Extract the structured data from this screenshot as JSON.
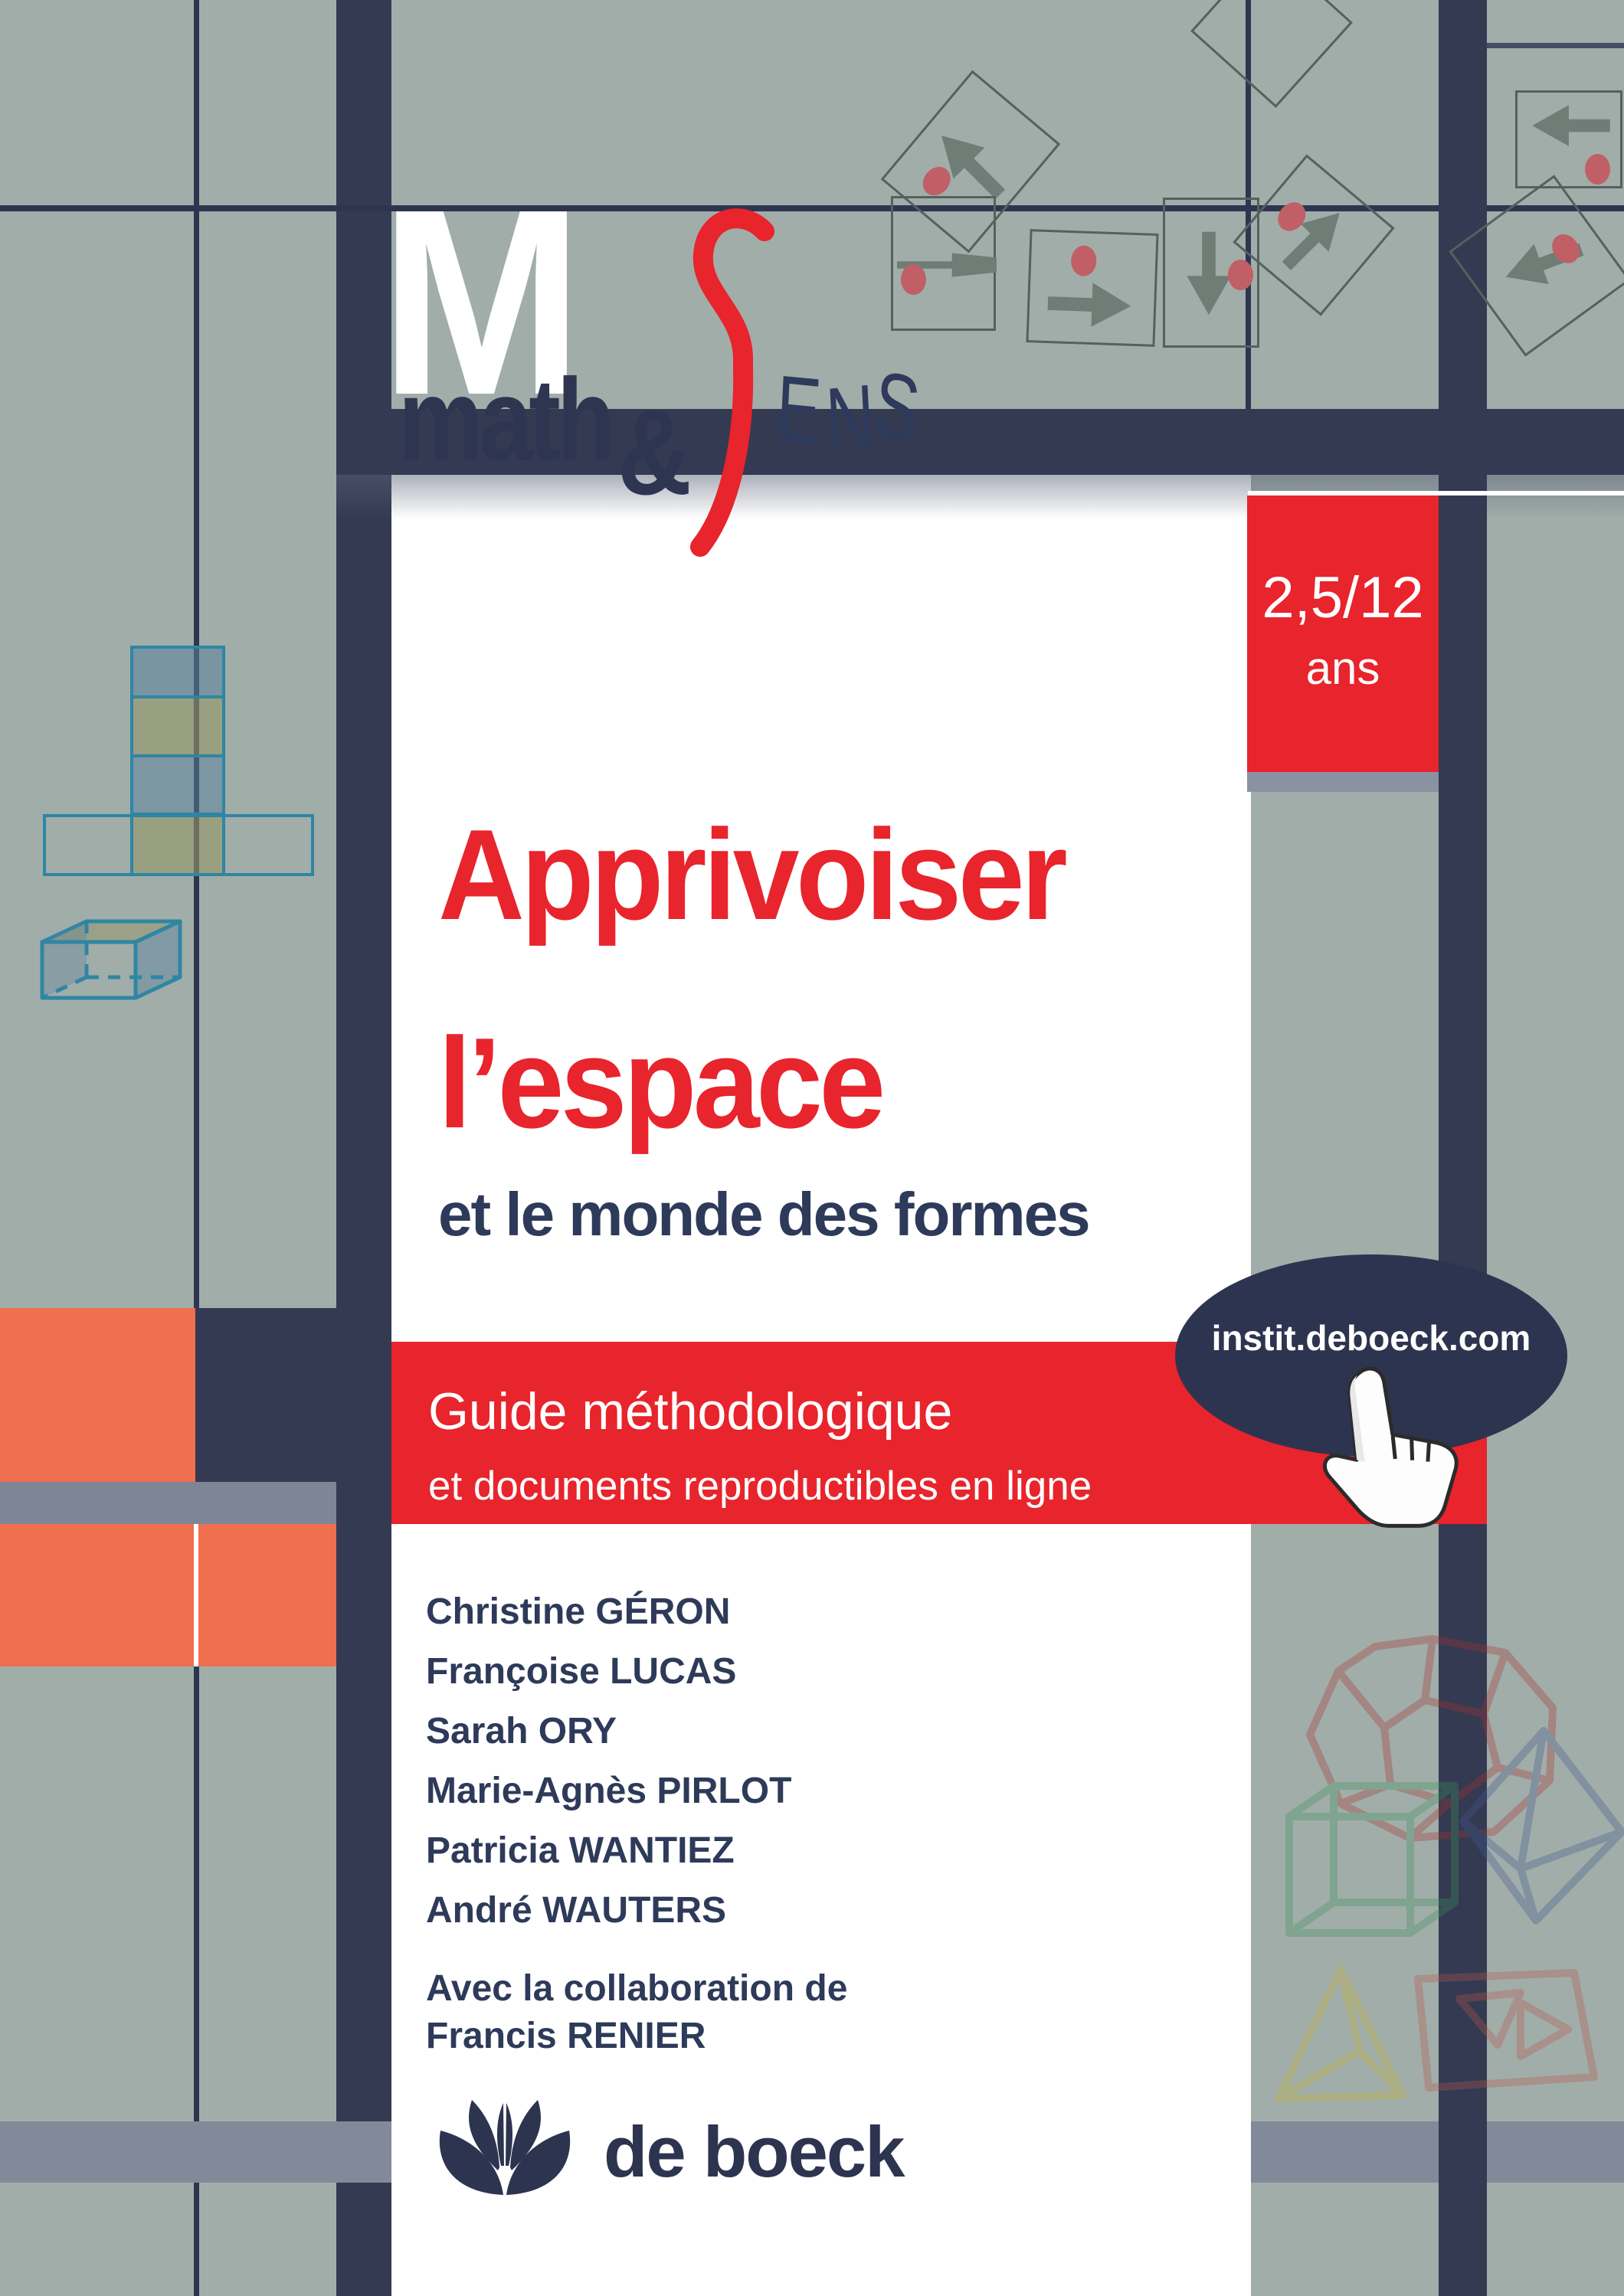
{
  "logo": {
    "m": "M",
    "math": "math",
    "amp": "&",
    "e": "E",
    "n": "N",
    "s_script": "S",
    "s2": "S"
  },
  "badge": {
    "line1": "2,5/12",
    "line2": "ans"
  },
  "title": {
    "line1": "Apprivoiser",
    "line2": "l’espace",
    "subtitle": "et le monde des formes"
  },
  "band": {
    "line1": "Guide méthodologique",
    "line2": "et documents reproductibles en ligne"
  },
  "oval": {
    "url": "instit.deboeck.com"
  },
  "authors": [
    "Christine GÉRON",
    "Françoise LUCAS",
    "Sarah ORY",
    "Marie-Agnès PIRLOT",
    "Patricia WANTIEZ",
    "André WAUTERS"
  ],
  "collaboration": {
    "line1": "Avec la collaboration de",
    "line2": "Francis RENIER"
  },
  "publisher": {
    "name": "de boeck"
  },
  "icons": [
    "arrow-tile-up-left",
    "arrow-tile-up",
    "arrow-tile-right",
    "arrow-tile-down",
    "arrow-tile-up-right",
    "arrow-tile-left",
    "arrow-tile-down-left",
    "cube-net",
    "cube-3d",
    "hand-cursor",
    "lotus-logo",
    "dodecahedron",
    "cube-frame",
    "octahedron",
    "tetrahedron",
    "pyramid-net"
  ],
  "colors": {
    "sage": "#a1ada9",
    "navy": "#333a52",
    "deep_navy": "#2d3450",
    "red": "#e8242c",
    "orange": "#ef6f4f",
    "gray_band": "#7e8594",
    "teal_net": "#2f86a3",
    "title_navy": "#2e3a5a",
    "white": "#ffffff"
  }
}
